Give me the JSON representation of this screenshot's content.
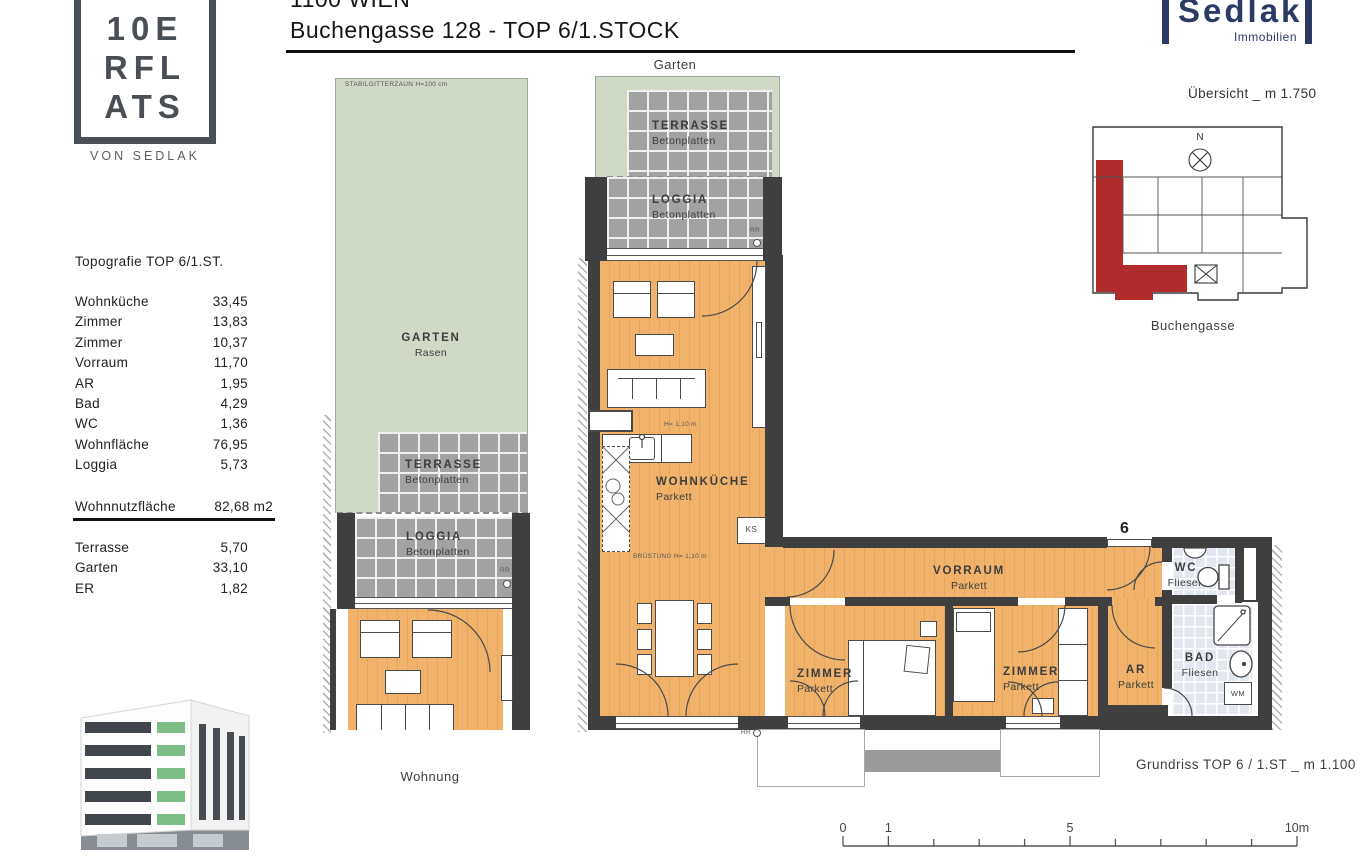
{
  "header": {
    "city": "1100 WIEN",
    "address": "Buchengasse  128 - TOP 6/1.STOCK"
  },
  "logo": {
    "line1": "10E",
    "line2": "RFL",
    "line3": "ATS",
    "subtitle": "VON SEDLAK"
  },
  "brand": {
    "name": "Sedlak",
    "subtitle": "Immobilien"
  },
  "overview": {
    "title": "Übersicht _ m 1.750",
    "north": "N",
    "street": "Buchengasse"
  },
  "topografie": {
    "title": "Topografie  TOP  6/1.ST.",
    "rows": [
      {
        "label": "Wohnküche",
        "value": "33,45"
      },
      {
        "label": "Zimmer",
        "value": "13,83"
      },
      {
        "label": "Zimmer",
        "value": "10,37"
      },
      {
        "label": "Vorraum",
        "value": "11,70"
      },
      {
        "label": "AR",
        "value": "1,95"
      },
      {
        "label": "Bad",
        "value": "4,29"
      },
      {
        "label": "WC",
        "value": "1,36"
      },
      {
        "label": "Wohnfläche",
        "value": "76,95"
      },
      {
        "label": "Loggia",
        "value": "5,73"
      }
    ],
    "total": {
      "label": "Wohnnutzfläche",
      "value": "82,68 m2"
    },
    "outdoor": [
      {
        "label": "Terrasse",
        "value": "5,70"
      },
      {
        "label": "Garten",
        "value": "33,10"
      },
      {
        "label": "ER",
        "value": "1,82"
      }
    ]
  },
  "plan": {
    "garten_label": "Garten",
    "wohnung_label": "Wohnung",
    "fence_note": "STABILGITTERZAUN H=100 cm",
    "rooms": {
      "garten": {
        "name": "GARTEN",
        "finish": "Rasen"
      },
      "terrasse_left": {
        "name": "TERRASSE",
        "finish": "Betonplatten"
      },
      "loggia_left": {
        "name": "LOGGIA",
        "finish": "Betonplatten"
      },
      "terrasse_right": {
        "name": "TERRASSE",
        "finish": "Betonplatten"
      },
      "loggia_right": {
        "name": "LOGGIA",
        "finish": "Betonplatten"
      },
      "wohnkueche": {
        "name": "WOHNKÜCHE",
        "finish": "Parkett"
      },
      "vorraum": {
        "name": "VORRAUM",
        "finish": "Parkett"
      },
      "zimmer1": {
        "name": "ZIMMER",
        "finish": "Parkett"
      },
      "zimmer2": {
        "name": "ZIMMER",
        "finish": "Parkett"
      },
      "ar": {
        "name": "AR",
        "finish": "Parkett"
      },
      "bad": {
        "name": "BAD",
        "finish": "Fliesen"
      },
      "wc": {
        "name": "WC",
        "finish": "Fliesen"
      }
    },
    "annotations": {
      "unit_number": "6",
      "ks": "KS",
      "wm": "WM",
      "rr": "RR",
      "height_note": "H= 1,10 m",
      "bruestung_note": "BRÜSTUNG H= 1,10 m"
    }
  },
  "caption": {
    "grundriss": "Grundriss   TOP 6 / 1.ST  _ m 1.100"
  },
  "scalebar": {
    "labels": [
      "0",
      "1",
      "5",
      "10m"
    ]
  },
  "colors": {
    "accent_red": "#b02c2c",
    "brand_navy": "#2c3a66",
    "parkett": "#f0b269",
    "tile_gray": "#a2a2a2",
    "tile_bath": "#e3e8f0",
    "garden_green": "#cfd9c6",
    "wall": "#3f3f3f"
  }
}
